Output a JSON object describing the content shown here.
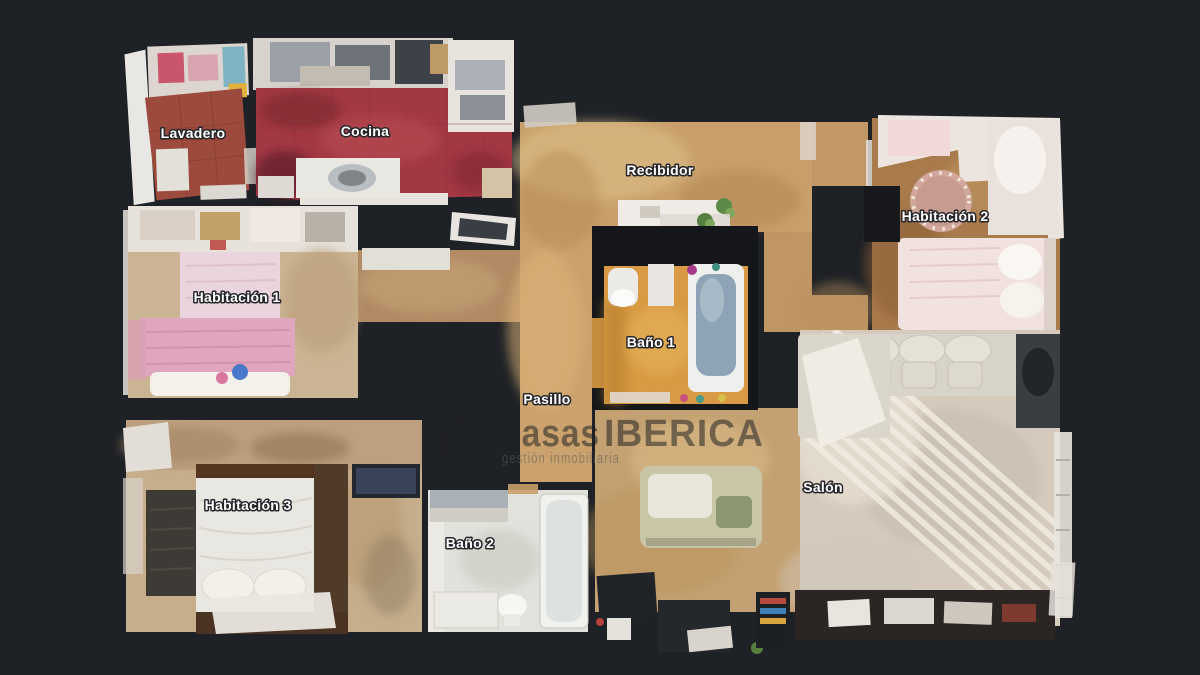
{
  "page": {
    "background": "#1e2126",
    "description": "3D top-down dollhouse floor plan of an apartment"
  },
  "floorplan": {
    "rooms": [
      {
        "id": "lavadero",
        "label": "Lavadero"
      },
      {
        "id": "cocina",
        "label": "Cocina"
      },
      {
        "id": "recibidor",
        "label": "Recibidor"
      },
      {
        "id": "habitacion-2",
        "label": "Habitación 2"
      },
      {
        "id": "habitacion-1",
        "label": "Habitación 1"
      },
      {
        "id": "bano-1",
        "label": "Baño 1"
      },
      {
        "id": "pasillo",
        "label": "Pasillo"
      },
      {
        "id": "salon",
        "label": "Salón"
      },
      {
        "id": "habitacion-3",
        "label": "Habitación 3"
      },
      {
        "id": "bano-2",
        "label": "Baño 2"
      }
    ],
    "label_style": {
      "color": "#ffffff",
      "outline": "#26262a"
    }
  },
  "watermark": {
    "brand_part1": "casas",
    "brand_part2": "IBERICA",
    "tagline": "gestión inmobiliaria",
    "brand_color": "#242424",
    "tagline_color": "#5e5e5e"
  },
  "colors": {
    "background": "#1e2126",
    "kitchen_floor": "#a23844",
    "laundry_floor": "#9c4a3b",
    "hall_floor": "#c9a06b",
    "link_corridor_floor": "#b28a63",
    "bedroom1_bedspread": "#e0a6bd",
    "bedroom2_floor": "#a87a4c",
    "bath1_floor": "#d89a42",
    "salon_floor": "#d5cabc",
    "bedroom3_floor": "#c6ae8c",
    "bath2_floor": "#e2e2dd",
    "wall_dark": "#141619"
  }
}
